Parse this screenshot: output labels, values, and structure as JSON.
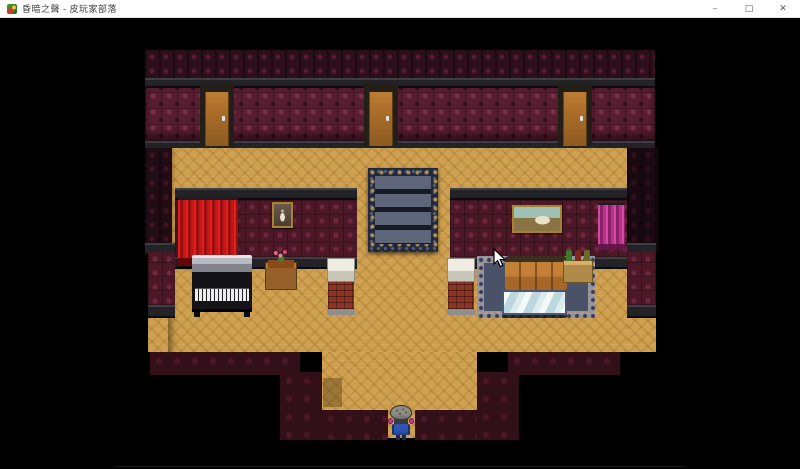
{
  "window": {
    "title": "昏暗之聲 - 皮玩家部落",
    "icon": "game-app-icon",
    "controls": {
      "minimize": "–",
      "maximize": "□",
      "close": "✕"
    }
  },
  "game": {
    "scene_name": "mansion-parlor-interior",
    "player": {
      "description": "small sprite with mottled gray helmet, pink ear guards, dark blue outfit, standing in bottom doorway facing down"
    },
    "objects": [
      "door-left",
      "door-center",
      "door-right",
      "staircase-rug",
      "red-curtain",
      "portrait-painting",
      "landscape-painting",
      "magenta-curtain",
      "upright-piano",
      "flower-side-table",
      "brick-column-left",
      "brick-column-right",
      "leather-sofa",
      "glass-coffee-table",
      "bottle-shelf",
      "player-character",
      "mouse-cursor"
    ],
    "colors": {
      "background": "#000000",
      "floor": "#cfa050",
      "wall_main": "#571d30",
      "wall_dark": "#2c0f1b",
      "wall_dim": "#331019",
      "ledge": "#232327",
      "door": "#b0732e",
      "curtain_red": "#c51515",
      "curtain_magenta": "#b5338c",
      "stairs_steps": "#5d6679",
      "stairs_border": "#23283c",
      "rug": "#4a5268",
      "sofa": "#c07a30",
      "piano_body": "#141418",
      "brick": "#8d3424",
      "glass_table": "#cfe4e8",
      "titlebar": "#ffffff"
    }
  }
}
